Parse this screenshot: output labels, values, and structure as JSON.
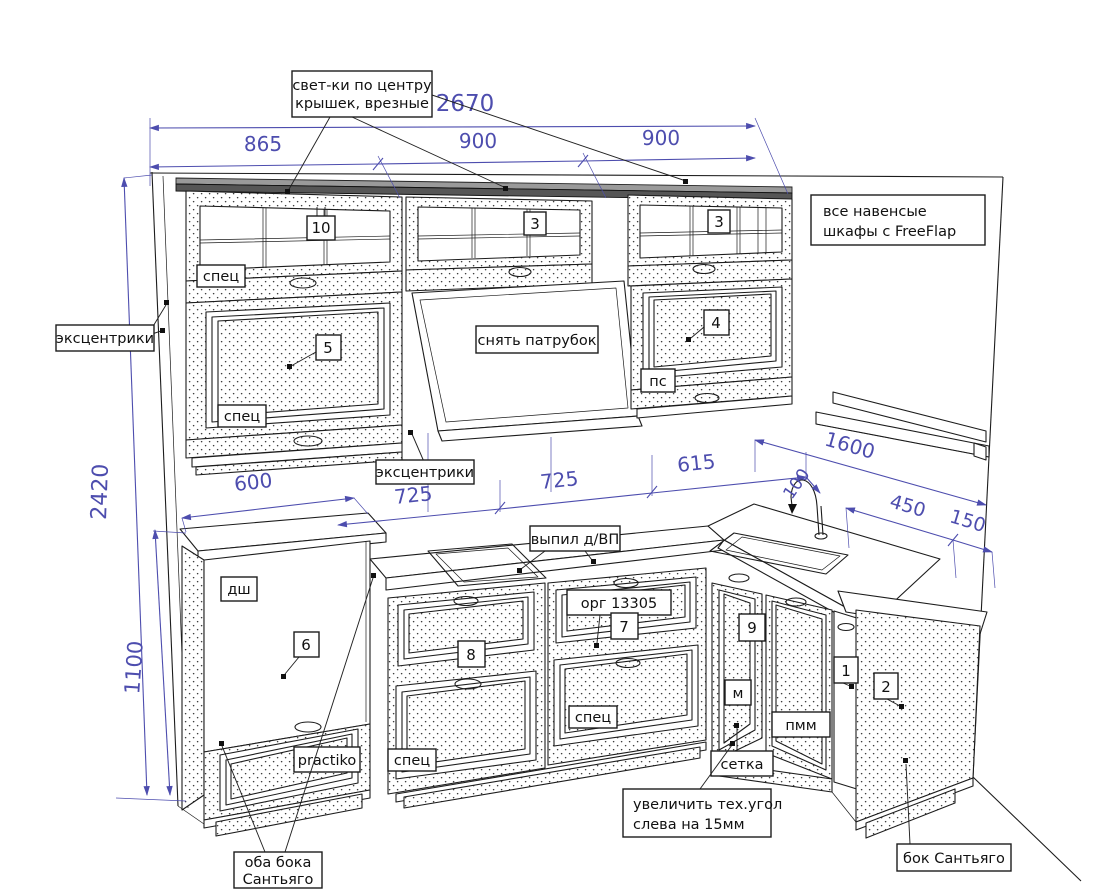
{
  "meta": {
    "drawing_type": "kitchen elevation technical drawing"
  },
  "colors": {
    "dimension": "#4d4dae",
    "line": "#1c1c1c"
  },
  "dims": {
    "total_width": "2670",
    "seg_left": "865",
    "seg_mid": "900",
    "seg_right": "900",
    "height_total": "2420",
    "height_base": "1100",
    "base_left_width": "600",
    "base_seg1": "725",
    "base_seg2": "725",
    "base_seg3": "615",
    "corner_gap": "100",
    "right_total": "1600",
    "right_seg": "450",
    "right_end": "150"
  },
  "callouts": {
    "lights": {
      "line1": "свет-ки по центру",
      "line2": "крышек, врезные"
    },
    "freeflap": {
      "line1": "все навенсые",
      "line2": "шкафы с FreeFlap"
    },
    "eccentrics_left": "эксцентрики",
    "eccentrics_mid": "эксцентрики",
    "spec": "спец",
    "remove_pipe": "снять патрубок",
    "ps": "пс",
    "cutout_vp": "выпил д/ВП",
    "org_number": "орг 13305",
    "practiko": "practiko",
    "dsh": "дш",
    "m": "м",
    "pmm": "пмм",
    "mesh": "сетка",
    "tech_corner": {
      "line1": "увеличить тех.угол",
      "line2": "слева на 15мм"
    },
    "side_santiago": "бок Сантьяго",
    "both_sides": {
      "line1": "оба бока",
      "line2": "Сантьяго"
    }
  },
  "markers": {
    "cab10": "10",
    "cab3a": "3",
    "cab3b": "3",
    "cab5": "5",
    "cab4": "4",
    "cab6": "6",
    "cab8": "8",
    "cab7": "7",
    "cab9": "9",
    "cab1": "1",
    "cab2": "2"
  }
}
